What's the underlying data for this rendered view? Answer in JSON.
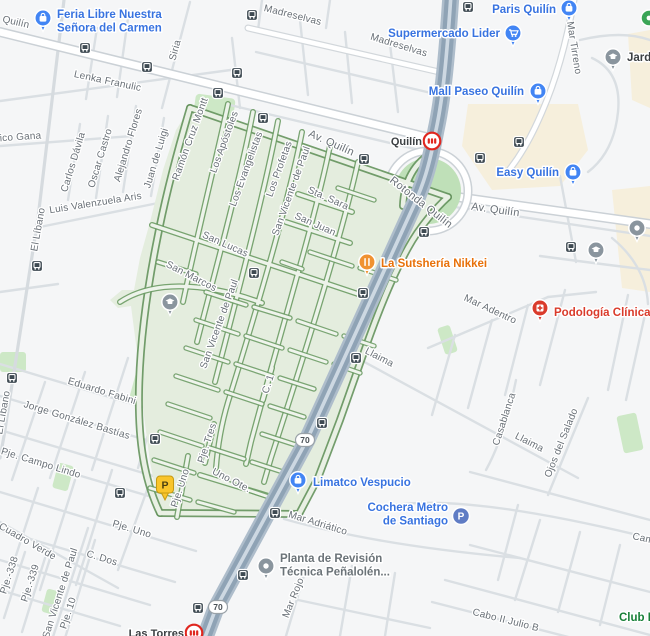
{
  "colors": {
    "land": "#F5F6F7",
    "beige_area": "#F6EFDC",
    "park_green": "#CDE8C6",
    "roundabout_green": "#BFE0B8",
    "zone_fill": "#E4EDDE",
    "zone_street_casing": "#6B9B64",
    "highway": "#8FA3B5",
    "poi_blue_text": "#3873E0",
    "poi_blue_icon": "#4285F4",
    "poi_orange_text": "#E8710A",
    "poi_orange_icon": "#F09231",
    "poi_red_text": "#DA3B2B",
    "poi_red_icon": "#DA3B2B",
    "poi_gray_text": "#6B7378",
    "poi_dark_text": "#3C4043",
    "poi_green_text": "#188038",
    "poi_gray_icon": "#8A959E",
    "bus_icon": "#3E4A52",
    "metro_red": "#E0271F",
    "parking_circle": "#5F7CC4",
    "parking_pin_yellow": "#F9C52B",
    "street_label": "#697077"
  },
  "street_labels": [
    {
      "text": "Quilín",
      "x": 2,
      "y": 22,
      "rot": 13,
      "anchor": "start"
    },
    {
      "text": "Madreselvas",
      "x": 292,
      "y": 18,
      "rot": 14
    },
    {
      "text": "Madreselvas",
      "x": 398,
      "y": 48,
      "rot": 17
    },
    {
      "text": "Siria",
      "x": 178,
      "y": 51,
      "rot": -75
    },
    {
      "text": "Lenka Franulic",
      "x": 107,
      "y": 84,
      "rot": 12
    },
    {
      "text": "rico Gana",
      "x": 19,
      "y": 140,
      "rot": -4
    },
    {
      "text": "Carlos Dávila",
      "x": 76,
      "y": 163,
      "rot": -73
    },
    {
      "text": "Oscar Castro",
      "x": 103,
      "y": 159,
      "rot": -73
    },
    {
      "text": "Alejandro Flores",
      "x": 131,
      "y": 146,
      "rot": -73
    },
    {
      "text": "Juan de Luigi",
      "x": 159,
      "y": 159,
      "rot": -73
    },
    {
      "text": "Luis Valenzuela Aris",
      "x": 96,
      "y": 206,
      "rot": -9
    },
    {
      "text": "El Líbano",
      "x": 41,
      "y": 230,
      "rot": -80
    },
    {
      "text": "El Líbano",
      "x": 6,
      "y": 413,
      "rot": -80
    },
    {
      "text": "Ramón Cruz Montt",
      "x": 193,
      "y": 140,
      "rot": -70
    },
    {
      "text": "Los Apóstoles",
      "x": 227,
      "y": 143,
      "rot": -70
    },
    {
      "text": "Los Evangelistas",
      "x": 249,
      "y": 170,
      "rot": -70
    },
    {
      "text": "Los Profetas",
      "x": 282,
      "y": 170,
      "rot": -70
    },
    {
      "text": "San Vicente de Paul",
      "x": 294,
      "y": 192,
      "rot": -70
    },
    {
      "text": "Av. Quilín",
      "x": 330,
      "y": 146,
      "rot": 24,
      "big": true
    },
    {
      "text": "Av. Quilín",
      "x": 495,
      "y": 213,
      "rot": 8,
      "big": true
    },
    {
      "text": "Rotonda Quilín",
      "x": 419,
      "y": 205,
      "rot": 38,
      "big": true
    },
    {
      "text": "Sta. Sara",
      "x": 327,
      "y": 201,
      "rot": 24
    },
    {
      "text": "San Juan",
      "x": 314,
      "y": 227,
      "rot": 24
    },
    {
      "text": "San Lucas",
      "x": 224,
      "y": 247,
      "rot": 24
    },
    {
      "text": "San Marcos",
      "x": 190,
      "y": 279,
      "rot": 27
    },
    {
      "text": "San Vicente de Paul",
      "x": 222,
      "y": 325,
      "rot": -70
    },
    {
      "text": "Mar Adentro",
      "x": 489,
      "y": 312,
      "rot": 25
    },
    {
      "text": "Llaima",
      "x": 378,
      "y": 360,
      "rot": 27
    },
    {
      "text": "Llaima",
      "x": 528,
      "y": 445,
      "rot": 27
    },
    {
      "text": "Casablanca",
      "x": 507,
      "y": 420,
      "rot": -72
    },
    {
      "text": "Ojos del Salado",
      "x": 564,
      "y": 444,
      "rot": -68
    },
    {
      "text": "Eduardo Fabini",
      "x": 101,
      "y": 394,
      "rot": 17
    },
    {
      "text": "Jorge González Bastías",
      "x": 76,
      "y": 423,
      "rot": 17
    },
    {
      "text": "Pje. Campo Lindo",
      "x": 40,
      "y": 466,
      "rot": 17
    },
    {
      "text": "C. 1",
      "x": 271,
      "y": 385,
      "rot": -72
    },
    {
      "text": "Pje. Tres",
      "x": 210,
      "y": 444,
      "rot": -72
    },
    {
      "text": "Uno Ote.",
      "x": 230,
      "y": 483,
      "rot": 27
    },
    {
      "text": "Pje. Uno",
      "x": 183,
      "y": 489,
      "rot": -72
    },
    {
      "text": "Pje. Uno",
      "x": 131,
      "y": 532,
      "rot": 17
    },
    {
      "text": "C. Dos",
      "x": 101,
      "y": 561,
      "rot": 17
    },
    {
      "text": "Cuadro Verde",
      "x": 26,
      "y": 544,
      "rot": 30
    },
    {
      "text": "San Vicente de Paul",
      "x": 63,
      "y": 594,
      "rot": -72
    },
    {
      "text": "Pje. 10",
      "x": 71,
      "y": 614,
      "rot": -72
    },
    {
      "text": "Pje.-338",
      "x": 12,
      "y": 576,
      "rot": -72
    },
    {
      "text": "Pje.-339",
      "x": 33,
      "y": 584,
      "rot": -72
    },
    {
      "text": "Mar Adriático",
      "x": 317,
      "y": 526,
      "rot": 17
    },
    {
      "text": "Mar Rojo",
      "x": 296,
      "y": 599,
      "rot": -68
    },
    {
      "text": "Cabo II Julio B",
      "x": 505,
      "y": 623,
      "rot": 14
    },
    {
      "text": "Mar Tirreno",
      "x": 567,
      "y": 22,
      "rot": 81,
      "anchor": "start"
    },
    {
      "text": "Cam",
      "x": 632,
      "y": 539,
      "rot": 12,
      "anchor": "start"
    }
  ],
  "poi_labels": [
    {
      "id": "feria-libre-nuestra-senora-del-carmen",
      "lines": [
        "Feria Libre Nuestra",
        "Señora del Carmen"
      ],
      "x": 57,
      "y": 18,
      "anchor": "start",
      "color": "blue",
      "icon": {
        "type": "shopping-pin",
        "x": 43,
        "y": 18
      }
    },
    {
      "id": "supermercado-lider",
      "lines": [
        "Supermercado Lider"
      ],
      "x": 500,
      "y": 37,
      "anchor": "end",
      "color": "blue",
      "icon": {
        "type": "cart-pin",
        "x": 513,
        "y": 33
      }
    },
    {
      "id": "paris-quilin",
      "lines": [
        "Paris Quilín"
      ],
      "x": 556,
      "y": 13,
      "anchor": "end",
      "color": "blue",
      "icon": {
        "type": "shopping-pin",
        "x": 569,
        "y": 8
      }
    },
    {
      "id": "mall-paseo-quilin",
      "lines": [
        "Mall Paseo Quilín"
      ],
      "x": 524,
      "y": 95,
      "anchor": "end",
      "color": "blue",
      "icon": {
        "type": "shopping-pin",
        "x": 538,
        "y": 91
      }
    },
    {
      "id": "easy-quilin",
      "lines": [
        "Easy Quilín"
      ],
      "x": 559,
      "y": 176,
      "anchor": "end",
      "color": "blue",
      "icon": {
        "type": "shopping-pin",
        "x": 573,
        "y": 172
      }
    },
    {
      "id": "jardin",
      "lines": [
        "Jard"
      ],
      "x": 627,
      "y": 61,
      "anchor": "start",
      "color": "dark",
      "icon": {
        "type": "school-pin",
        "x": 613,
        "y": 57
      }
    },
    {
      "id": "la-sutsheria-nikkei",
      "lines": [
        "La Sutshería Nikkei"
      ],
      "x": 381,
      "y": 267,
      "anchor": "start",
      "color": "orange",
      "icon": {
        "type": "restaurant-pin",
        "x": 367,
        "y": 262
      }
    },
    {
      "id": "podologia-clinica",
      "lines": [
        "Podología Clínica IC"
      ],
      "x": 554,
      "y": 316,
      "anchor": "start",
      "color": "red",
      "icon": {
        "type": "medical-pin",
        "x": 540,
        "y": 308
      }
    },
    {
      "id": "limatco-vespucio",
      "lines": [
        "Limatco Vespucio"
      ],
      "x": 313,
      "y": 486,
      "anchor": "start",
      "color": "blue",
      "icon": {
        "type": "shopping-pin",
        "x": 298,
        "y": 480
      }
    },
    {
      "id": "cochera-metro-de-santiago",
      "lines": [
        "Cochera Metro",
        "de Santiago"
      ],
      "x": 448,
      "y": 511,
      "anchor": "end",
      "color": "blue",
      "icon": {
        "type": "parking-circle",
        "x": 461,
        "y": 516
      }
    },
    {
      "id": "planta-revision-tecnica",
      "lines": [
        "Planta de Revisión",
        "Técnica Peñalolén..."
      ],
      "x": 280,
      "y": 562,
      "anchor": "start",
      "color": "gray",
      "icon": {
        "type": "dot-circle-pin",
        "x": 266,
        "y": 566
      }
    },
    {
      "id": "club",
      "lines": [
        "Club E"
      ],
      "x": 619,
      "y": 621,
      "anchor": "start",
      "color": "green",
      "icon": null
    },
    {
      "id": "park-poi",
      "lines": [],
      "x": 0,
      "y": 0,
      "anchor": "start",
      "color": "green",
      "icon": {
        "type": "park-dot",
        "x": 649,
        "y": 18
      }
    },
    {
      "id": "school-poi-2",
      "lines": [],
      "x": 0,
      "y": 0,
      "anchor": "start",
      "color": "gray",
      "icon": {
        "type": "school-pin",
        "x": 596,
        "y": 250
      }
    },
    {
      "id": "school-poi-3",
      "lines": [],
      "x": 0,
      "y": 0,
      "anchor": "start",
      "color": "gray",
      "icon": {
        "type": "school-pin",
        "x": 170,
        "y": 302
      }
    },
    {
      "id": "gray-poi",
      "lines": [],
      "x": 0,
      "y": 0,
      "anchor": "start",
      "color": "gray",
      "icon": {
        "type": "dot-circle-pin",
        "x": 637,
        "y": 228
      }
    }
  ],
  "transit": {
    "metro_stations": [
      {
        "name": "Quilín",
        "icon_x": 432,
        "icon_y": 141,
        "label_x": 422,
        "label_y": 145,
        "anchor": "end"
      },
      {
        "name": "Las Torres",
        "icon_x": 194,
        "icon_y": 633,
        "label_x": 184,
        "label_y": 637,
        "anchor": "end"
      }
    ],
    "bus_stops": [
      [
        85,
        48
      ],
      [
        147,
        67
      ],
      [
        252,
        15
      ],
      [
        237,
        73
      ],
      [
        468,
        7
      ],
      [
        218,
        93
      ],
      [
        263,
        118
      ],
      [
        364,
        159
      ],
      [
        519,
        142
      ],
      [
        480,
        158
      ],
      [
        424,
        232
      ],
      [
        571,
        247
      ],
      [
        37,
        266
      ],
      [
        254,
        273
      ],
      [
        363,
        293
      ],
      [
        356,
        358
      ],
      [
        322,
        423
      ],
      [
        12,
        378
      ],
      [
        155,
        439
      ],
      [
        120,
        493
      ],
      [
        275,
        513
      ],
      [
        243,
        575
      ],
      [
        198,
        608
      ]
    ],
    "route_shields": [
      {
        "text": "70",
        "x": 305,
        "y": 440
      },
      {
        "text": "70",
        "x": 218,
        "y": 607
      }
    ]
  },
  "markers": {
    "parking_pin": {
      "label": "P",
      "x": 165,
      "y": 500
    }
  }
}
